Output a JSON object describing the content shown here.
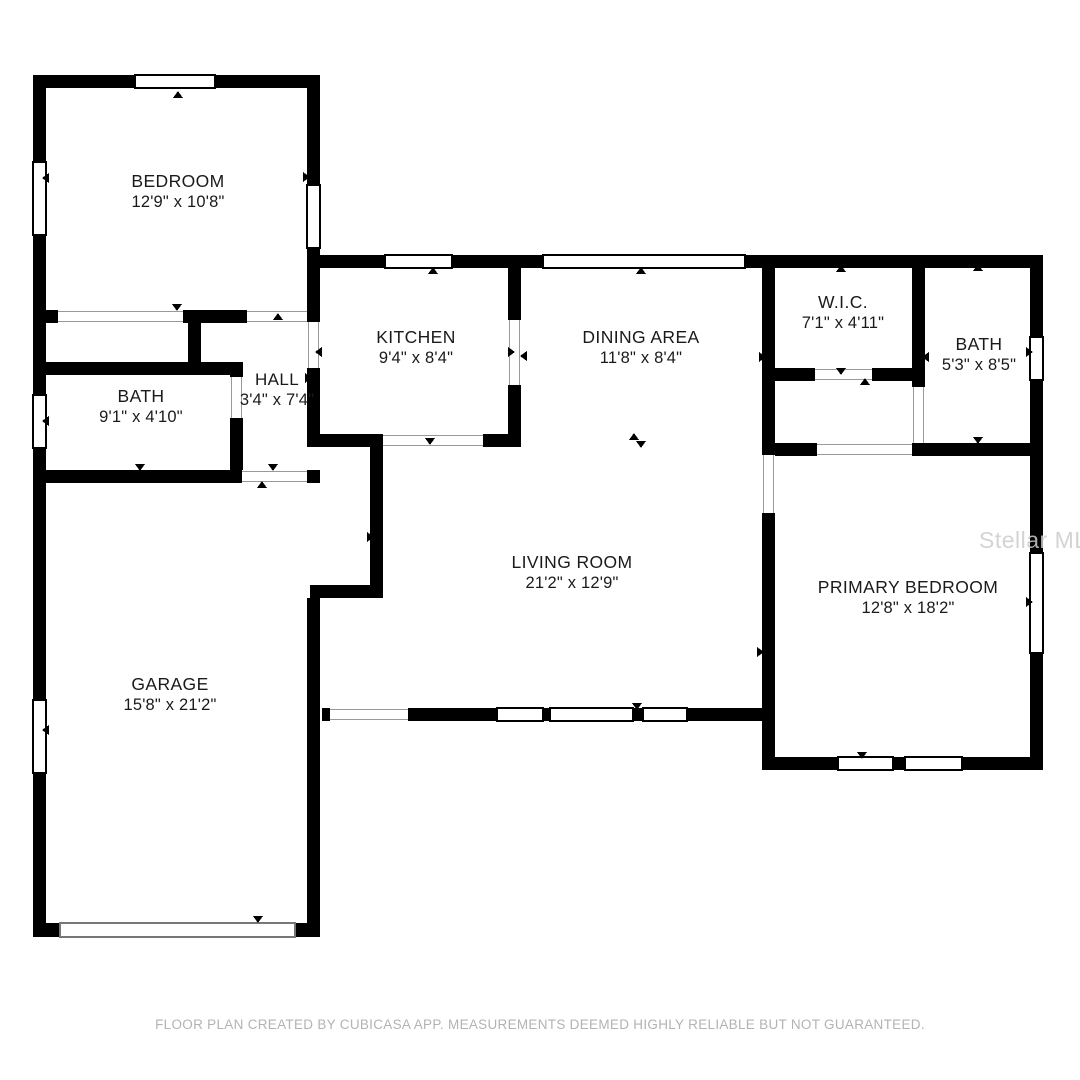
{
  "colors": {
    "background": "#ffffff",
    "wall": "#000000",
    "opening_line": "#999999",
    "footer_text": "#b3b3b3",
    "watermark_text": "#cccccc"
  },
  "rooms": [
    {
      "id": "bedroom",
      "name": "BEDROOM",
      "dims": "12'9\" x 10'8\""
    },
    {
      "id": "kitchen",
      "name": "KITCHEN",
      "dims": "9'4\" x 8'4\""
    },
    {
      "id": "dining",
      "name": "DINING AREA",
      "dims": "11'8\" x 8'4\""
    },
    {
      "id": "wic",
      "name": "W.I.C.",
      "dims": "7'1\" x 4'11\""
    },
    {
      "id": "bath-right",
      "name": "BATH",
      "dims": "5'3\" x 8'5\""
    },
    {
      "id": "bath-left",
      "name": "BATH",
      "dims": "9'1\" x 4'10\""
    },
    {
      "id": "hall",
      "name": "HALL",
      "dims": "3'4\" x 7'4\""
    },
    {
      "id": "living",
      "name": "LIVING ROOM",
      "dims": "21'2\" x 12'9\""
    },
    {
      "id": "primary",
      "name": "PRIMARY BEDROOM",
      "dims": "12'8\" x 18'2\""
    },
    {
      "id": "garage",
      "name": "GARAGE",
      "dims": "15'8\" x 21'2\""
    }
  ],
  "watermark": "Stellar MLS",
  "footer": "FLOOR PLAN CREATED BY CUBICASA APP. MEASUREMENTS DEEMED HIGHLY RELIABLE BUT NOT GUARANTEED."
}
